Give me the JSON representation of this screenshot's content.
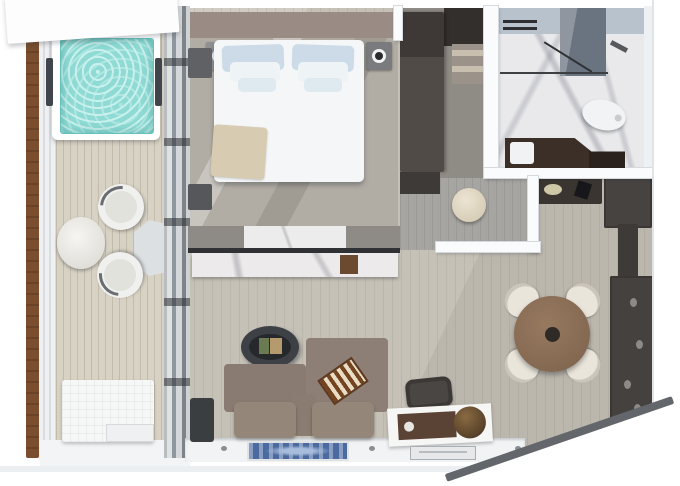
{
  "scene": {
    "title": "Top-down 3D rendered floor plan of a suite with private veranda",
    "view": "top-down 3d render",
    "canvas": {
      "width": 680,
      "height": 486
    },
    "visible_text": ""
  },
  "palette": {
    "exterior_white": "#ffffff",
    "wood_divider": "#7b4f2e",
    "deck_wood": "#d8d2c4",
    "whirlpool_water": "#8fdad5",
    "glass_frame_gray": "#8f979e",
    "bedroom_wall_taupe": "#9a8b84",
    "carpet_gray": "#b1aca4",
    "bed_linen_white": "#f4f6f7",
    "pillow_blue": "#ccdbe7",
    "throw_beige": "#d7cbb1",
    "lamp_teal": "#2f8391",
    "marble_white": "#e9e9eb",
    "bath_glass_blue": "#b7c2cd",
    "toilet_white": "#f2f3f4",
    "living_floor_wood": "#c6c1b7",
    "sofa_taupe": "#897b71",
    "coffee_table_dark": "#3d4145",
    "dining_table_brown": "#7c624c",
    "chair_cream": "#eae5da",
    "cabinet_dark": "#45413e",
    "radio_brown": "#5a4335",
    "globe_brown": "#42301e",
    "rug_blue": "#4a6aa0",
    "interior_wall_white": "#fafbfc"
  },
  "rooms": {
    "veranda": {
      "name": "Private veranda",
      "items": {
        "whirlpool": {
          "name": "Whirlpool hot tub"
        },
        "privacy_screen": {
          "name": "Wood privacy divider"
        },
        "balustrade": {
          "name": "Glass balustrade"
        },
        "outdoor_table": {
          "name": "Round outdoor table"
        },
        "outdoor_chair_upper": {
          "name": "Outdoor chair"
        },
        "outdoor_chair_lower": {
          "name": "Outdoor chair"
        },
        "lounger": {
          "name": "Outdoor lounger bench"
        },
        "deck_mat": {
          "name": "Deck mat"
        }
      }
    },
    "bedroom": {
      "name": "Bedroom",
      "items": {
        "bed": {
          "name": "Double bed with white duvet"
        },
        "pillows": {
          "name": "Blue and white pillows"
        },
        "throw": {
          "name": "Beige throw blanket"
        },
        "nightstand_left": {
          "name": "Nightstand with teal lamp"
        },
        "nightstand_right": {
          "name": "Nightstand with dark lamp"
        },
        "glass_doors": {
          "name": "Sliding glass doors to veranda"
        },
        "bench_upper": {
          "name": "Window bench"
        },
        "bench_lower": {
          "name": "Window bench"
        },
        "divider_console": {
          "name": "Marble console room divider"
        }
      }
    },
    "closet": {
      "name": "Walk-in closet",
      "items": {
        "wardrobe": {
          "name": "Dark wardrobe"
        },
        "shelf": {
          "name": "Open shelving"
        },
        "pouf": {
          "name": "Round cream pouf"
        }
      }
    },
    "bathroom": {
      "name": "Marble bathroom",
      "items": {
        "shower": {
          "name": "Glass walk-in shower"
        },
        "shower_head": {
          "name": "Shower head"
        },
        "toilet": {
          "name": "Toilet"
        },
        "vanity": {
          "name": "Dark vanity counter"
        },
        "sink": {
          "name": "Sink"
        },
        "towel_rail": {
          "name": "Towel rails"
        }
      }
    },
    "entry": {
      "name": "Entry nook",
      "items": {
        "console": {
          "name": "Dark console with lamp"
        },
        "tall_cabinet": {
          "name": "Tall entry cabinet"
        }
      }
    },
    "living": {
      "name": "Living room",
      "items": {
        "sofa": {
          "name": "Taupe sofa"
        },
        "backgammon": {
          "name": "Backgammon board"
        },
        "coffee_table": {
          "name": "Oval coffee table with books"
        },
        "side_chair": {
          "name": "Dark side chair"
        },
        "desk_chair": {
          "name": "Chair"
        },
        "media_console": {
          "name": "Console with radio and globe"
        },
        "rug": {
          "name": "Blue patterned runner rug"
        },
        "doormat": {
          "name": "Doormat"
        }
      }
    },
    "dining": {
      "name": "Dining area",
      "items": {
        "table": {
          "name": "Round wooden dining table"
        },
        "chair": {
          "name": "Cream dining chair"
        },
        "wall_unit": {
          "name": "Dark wall shelving unit"
        }
      }
    }
  }
}
